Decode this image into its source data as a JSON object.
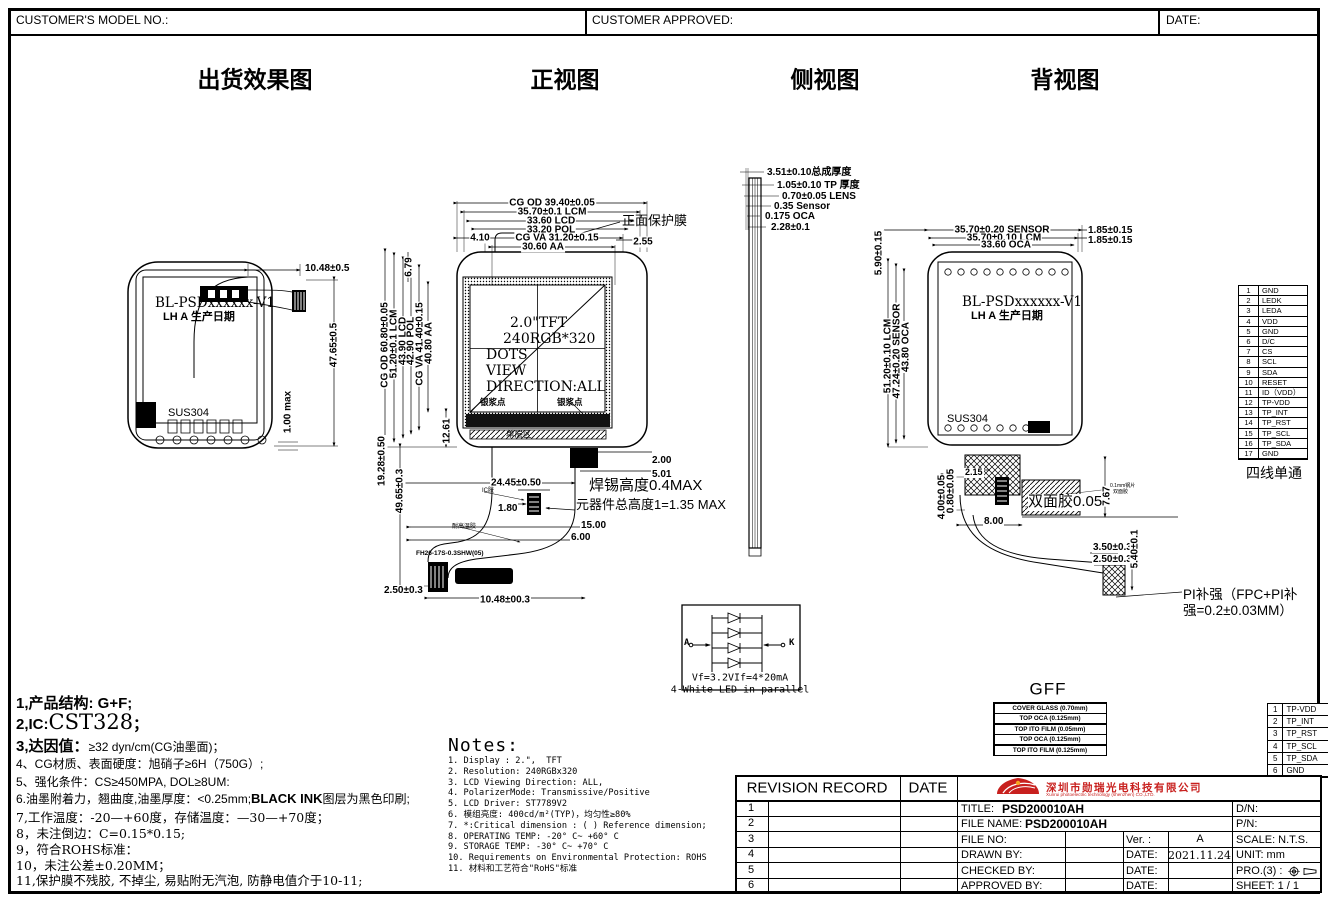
{
  "header": {
    "model_no": "CUSTOMER'S MODEL NO.:",
    "approved": "CUSTOMER APPROVED:",
    "date": "DATE:"
  },
  "titles": {
    "ship": "出货效果图",
    "front": "正视图",
    "side": "侧视图",
    "back": "背视图"
  },
  "ship": {
    "line1": "BL-PSDxxxxxx-V1",
    "line2": "LH A 生产日期",
    "sus": "SUS304",
    "w": "10.48±0.5",
    "h": "47.65±0.5",
    "t": "1.00 max"
  },
  "front": {
    "t0": "CG OD 39.40±0.05",
    "t1": "35.70±0.1 LCM",
    "t2": "33.60 LCD",
    "t3": "33.20 POL",
    "t4": "CG VA 31.20±0.15",
    "t5": "30.60 AA",
    "t410": "4.10",
    "t255": "2.55",
    "film": "正面保护膜",
    "l0": "CG OD 60.80±0.05",
    "l1": "51.20±0.1 LCM",
    "l2": "43.90 LCD",
    "l3": "42.90 POL",
    "l4": "CG VA 41.40±0.15",
    "l5": "40.80 AA",
    "d679": "6.79",
    "d1261": "12.61",
    "d1928": "19.28±0.50",
    "d4965": "49.65±0.3",
    "s1": "2.0\"TFT",
    "s2": "240RGB*320",
    "s3": "DOTS",
    "s4": "VIEW",
    "s5": "DIRECTION:ALL",
    "silver_l": "银浆点",
    "silver_r": "银浆点",
    "layer": "单层区",
    "d200": "2.00",
    "d501": "5.01",
    "d2445": "24.45±0.50",
    "d180": "1.80",
    "solder1": "焊锡高度0.4MAX",
    "solder2": "元器件总高度1=1.35 MAX",
    "d1500": "15.00",
    "d600": "6.00",
    "glue1": "IC胶",
    "glue2": "耐高温胶",
    "conn": "FH26-17S-0.3SHW(05)",
    "d250": "2.50±0.3",
    "d1048": "10.48±00.3"
  },
  "side": {
    "d0": "3.51±0.10总成厚度",
    "d1": "1.05±0.10 TP 厚度",
    "d2": "0.70±0.05 LENS",
    "d3": "0.35 Sensor",
    "d4": "0.175 OCA",
    "d5": "2.28±0.1"
  },
  "back": {
    "t0": "35.70±0.20 SENSOR",
    "t1": "35.70±0.10 LCM",
    "t2": "33.60 OCA",
    "r0": "1.85±0.15",
    "r1": "1.85±0.15",
    "l0": "5.90±0.15",
    "l1": "51.20±0.10 LCM",
    "l2": "47.24±0.20 SENSOR",
    "l3": "43.80 OCA",
    "line1": "BL-PSDxxxxxx-V1",
    "line2": "LH A 生产日期",
    "sus": "SUS304",
    "d215": "2.15",
    "d400": "4.00±0.05",
    "d080": "0.80±0.05",
    "d800": "8.00",
    "tape": "双面胶0.05",
    "d767": "7.67",
    "tiny1": "0.1mm钢片",
    "tiny2": "双面胶",
    "d350": "3.50±0.3",
    "d250": "2.50±0.3",
    "d540": "5.40±0.1",
    "pi1": "PI补强（FPC+PI补",
    "pi2": "强=0.2±0.03MM）"
  },
  "pins": {
    "caption": "四线单通",
    "rows": [
      {
        "n": "1",
        "label": "GND"
      },
      {
        "n": "2",
        "label": "LEDK"
      },
      {
        "n": "3",
        "label": "LEDA"
      },
      {
        "n": "4",
        "label": "VDD"
      },
      {
        "n": "5",
        "label": "GND"
      },
      {
        "n": "6",
        "label": "D/C"
      },
      {
        "n": "7",
        "label": "CS"
      },
      {
        "n": "8",
        "label": "SCL"
      },
      {
        "n": "9",
        "label": "SDA"
      },
      {
        "n": "10",
        "label": "RESET"
      },
      {
        "n": "11",
        "label": "ID（VDD）"
      },
      {
        "n": "12",
        "label": "TP-VDD"
      },
      {
        "n": "13",
        "label": "TP_INT"
      },
      {
        "n": "14",
        "label": "TP_RST"
      },
      {
        "n": "15",
        "label": "TP_SCL"
      },
      {
        "n": "16",
        "label": "TP_SDA"
      },
      {
        "n": "17",
        "label": "GND"
      }
    ]
  },
  "led": {
    "a": "A",
    "k": "K",
    "line1": "Vf=3.2VIf=4*20mA",
    "line2": "4-White LED in parallel"
  },
  "gff": {
    "title": "GFF",
    "layers": [
      "COVER GLASS (0.70mm)",
      "TOP OCA (0.125mm)",
      "TOP ITO FILM (0.05mm)",
      "TOP OCA (0.125mm)",
      "TOP ITO FILM (0.125mm)"
    ]
  },
  "tp": {
    "rows": [
      {
        "n": "1",
        "label": "TP-VDD"
      },
      {
        "n": "2",
        "label": "TP_INT"
      },
      {
        "n": "3",
        "label": "TP_RST"
      },
      {
        "n": "4",
        "label": "TP_SCL"
      },
      {
        "n": "5",
        "label": "TP_SDA"
      },
      {
        "n": "6",
        "label": "GND"
      }
    ]
  },
  "notes_cn": {
    "l1": "1,产品结构: G+F;",
    "l2a": "2,IC:",
    "l2b": "CST328",
    "l2c": "；",
    "l3a": "3,达因值：",
    "l3b": "≥32 dyn/cm(CG油墨面)；",
    "l4": "4、CG材质、表面硬度：旭硝子≥6H（750G）;",
    "l5": "5、强化条件：CS≥450MPA, DOL≥8UM:",
    "l6a": "6.油墨附着力，翘曲度,油墨厚度：<0.25mm;",
    "l6b": "BLACK INK",
    "l6c": "图层为黑色印刷;",
    "l7": "7,工作温度：-20—+60度，存储温度：—30—+70度；",
    "l8": "8，未注倒边：C=0.15*0.15;",
    "l9": "9，符合ROHS标准：",
    "l10": "10，未注公差±0.20MM；",
    "l11": "11,保护膜不残胶, 不掉尘, 易贴附无汽泡, 防静电值介于10-11;"
  },
  "notes_en": {
    "title": "Notes:",
    "items": [
      "1. Display : 2.\",  TFT",
      "2. Resolution: 240RGBx320",
      "3. LCD Viewing Direction: ALL,",
      "4. PolarizerMode: Transmissive/Positive",
      "5. LCD Driver: ST7789V2",
      "6. 模组亮度: 400cd/m²(TYP)，均匀性≥80%",
      "7. *:Critical dimension : ( ) Reference dimension;",
      "8. OPERATING TEMP: -20° C~ +60° C",
      "9. STORAGE TEMP: -30° C~ +70° C",
      "10. Requirements on Environmental Protection: ROHS",
      "11. 材料和工艺符合\"RoHS\"标准"
    ]
  },
  "tb": {
    "rev": "REVISION RECORD",
    "date": "DATE",
    "nums": [
      "1",
      "2",
      "3",
      "4",
      "5",
      "6"
    ],
    "company_cn": "深圳市勋瑞光电科技有限公司",
    "company_en": "Xunrui photoelectric technology (shenzhen) CO.,LTD.",
    "title_label": "TITLE:",
    "title_value": "PSD200010AH",
    "dn": "D/N:",
    "file_label": "FILE NAME:",
    "file_value": "PSD200010AH",
    "pn": "P/N:",
    "file_no": "FILE NO:",
    "ver": "Ver. :",
    "ver_value": "A",
    "scale": "SCALE: N.T.S.",
    "drawn": "DRAWN BY:",
    "date_label": "DATE:",
    "drawn_date": "2021.11.24",
    "unit": "UNIT: mm",
    "checked": "CHECKED BY:",
    "pro": "PRO.(3) :",
    "approved": "APPROVED BY:",
    "sheet": "SHEET: 1 / 1"
  }
}
